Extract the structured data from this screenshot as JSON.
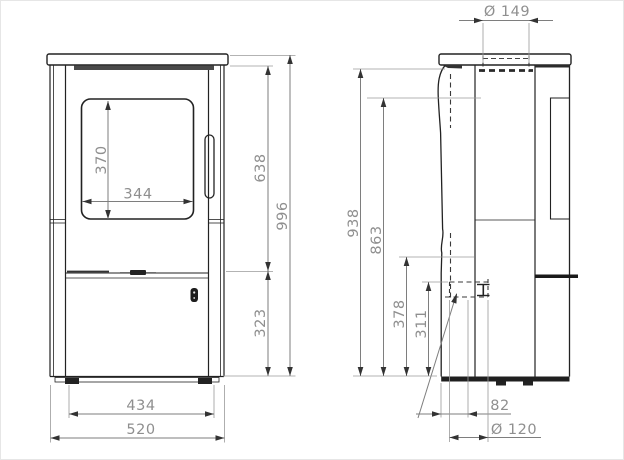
{
  "dims": {
    "flue_diameter": "Ø 149",
    "window_height": "370",
    "window_width": "344",
    "upper_section_height": "638",
    "overall_height": "996",
    "lower_section_height": "323",
    "foot_span": "434",
    "overall_width": "520",
    "side_overall_height": "938",
    "rear_outlet_height": "863",
    "air_inlet_top_height": "378",
    "air_inlet_center_height": "311",
    "air_inlet_offset": "82",
    "air_inlet_diameter": "Ø 120"
  }
}
